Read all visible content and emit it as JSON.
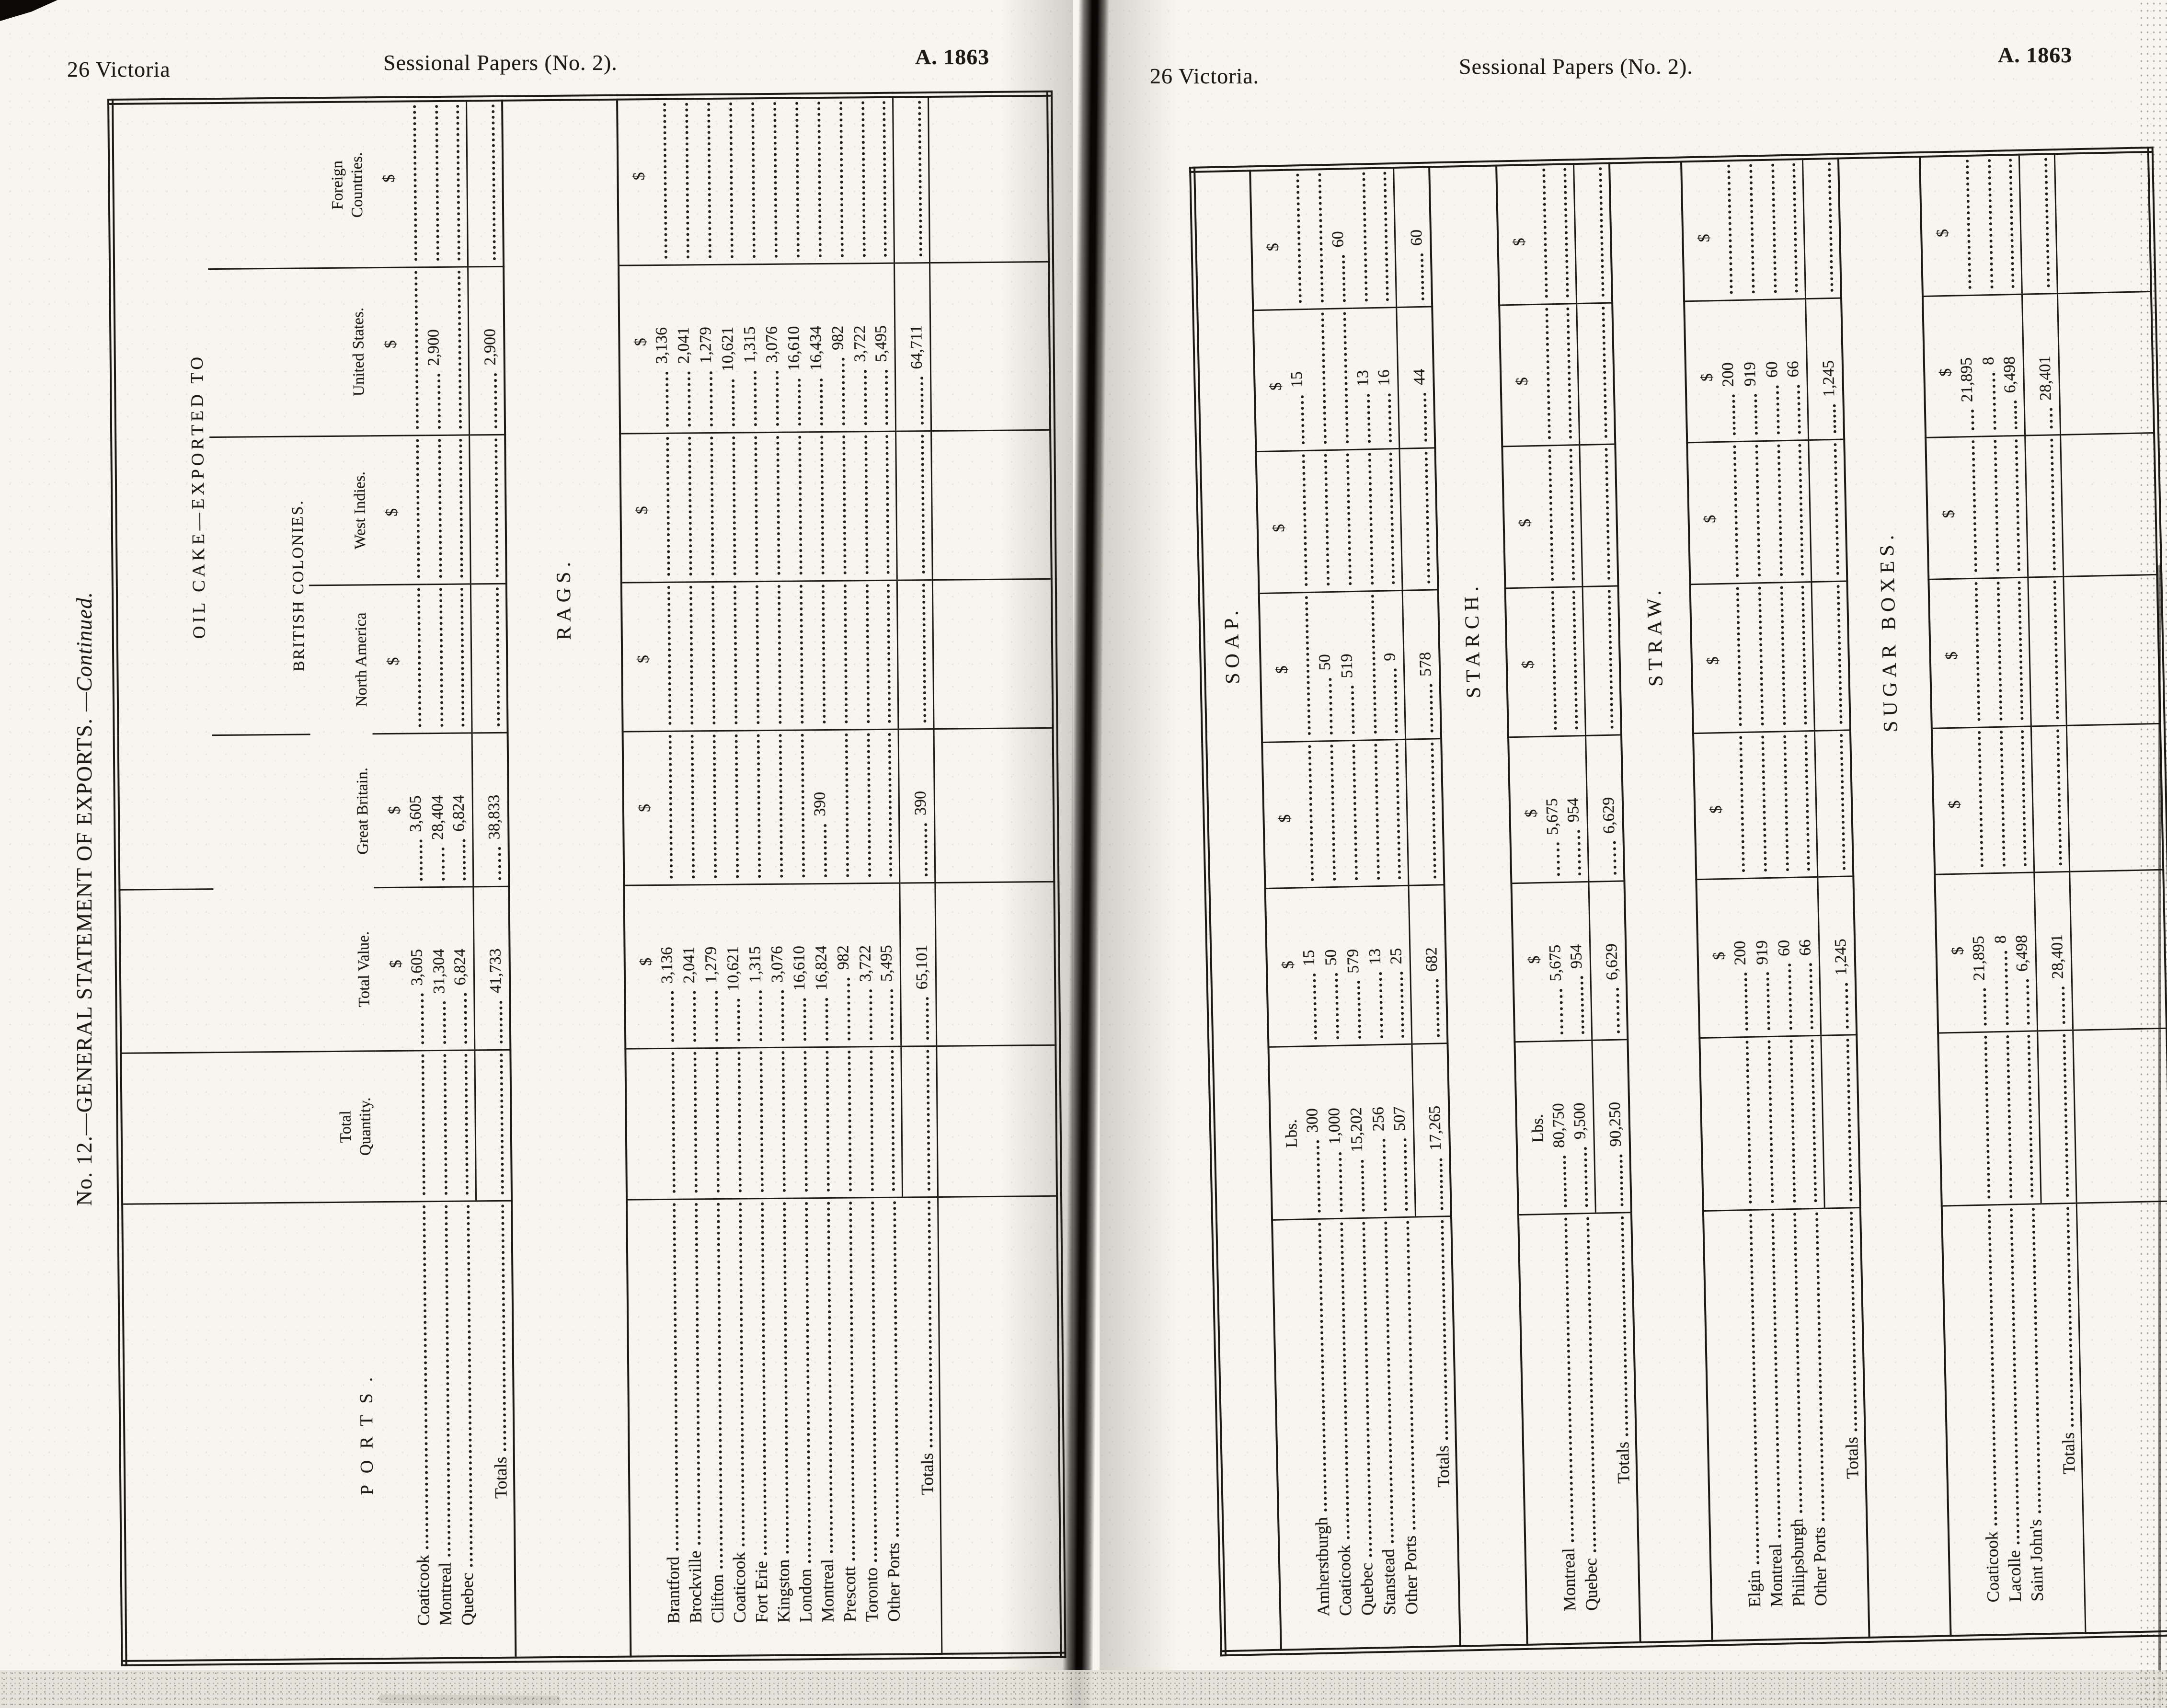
{
  "pages": {
    "left": {
      "header": {
        "left": "26 Victoria",
        "center": "Sessional Papers (No. 2).",
        "right": "A. 1863"
      },
      "side_title": {
        "main": "No. 12.—GENERAL STATEMENT OF EXPORTS.",
        "suffix": "—Continued."
      },
      "table": {
        "columns": [
          "port",
          "tq",
          "tv",
          "gb",
          "na",
          "wi",
          "us",
          "fc"
        ],
        "headers": {
          "ports": "PORTS.",
          "total_quantity": "Total Quantity.",
          "total_value": "Total Value.",
          "exported_to": "OIL CAKE—EXPORTED TO",
          "great_britain": "Great Britain.",
          "british_colonies": "BRITISH COLONIES.",
          "north_america": "North America",
          "west_indies": "West Indies.",
          "united_states": "United States.",
          "foreign_countries": "Foreign Countries."
        },
        "sections": [
          {
            "label": null,
            "units": {
              "tv": "$",
              "gb": "$",
              "na": "$",
              "wi": "$",
              "us": "$",
              "fc": "$"
            },
            "rows": [
              {
                "port": "Coaticook",
                "cells": {
                  "tv": "3,605",
                  "gb": "3,605"
                }
              },
              {
                "port": "Montreal",
                "cells": {
                  "tv": "31,304",
                  "gb": "28,404",
                  "us": "2,900"
                }
              },
              {
                "port": "Quebec",
                "cells": {
                  "tv": "6,824",
                  "gb": "6,824"
                }
              }
            ],
            "totals": {
              "port": "Totals",
              "cells": {
                "tv": "41,733",
                "gb": "38,833",
                "us": "2,900"
              }
            }
          },
          {
            "label": "RAGS.",
            "units": {
              "tv": "$",
              "gb": "$",
              "na": "$",
              "wi": "$",
              "us": "$",
              "fc": "$"
            },
            "rows": [
              {
                "port": "Brantford",
                "cells": {
                  "tv": "3,136",
                  "us": "3,136"
                }
              },
              {
                "port": "Brockville",
                "cells": {
                  "tv": "2,041",
                  "us": "2,041"
                }
              },
              {
                "port": "Clifton",
                "cells": {
                  "tv": "1,279",
                  "us": "1,279"
                }
              },
              {
                "port": "Coaticook",
                "cells": {
                  "tv": "10,621",
                  "us": "10,621"
                }
              },
              {
                "port": "Fort Erie",
                "cells": {
                  "tv": "1,315",
                  "us": "1,315"
                }
              },
              {
                "port": "Kingston",
                "cells": {
                  "tv": "3,076",
                  "us": "3,076"
                }
              },
              {
                "port": "London",
                "cells": {
                  "tv": "16,610",
                  "us": "16,610"
                }
              },
              {
                "port": "Montreal",
                "cells": {
                  "tv": "16,824",
                  "gb": "390",
                  "us": "16,434"
                }
              },
              {
                "port": "Prescott",
                "cells": {
                  "tv": "982",
                  "us": "982"
                }
              },
              {
                "port": "Toronto",
                "cells": {
                  "tv": "3,722",
                  "us": "3,722"
                }
              },
              {
                "port": "Other Ports",
                "cells": {
                  "tv": "5,495",
                  "us": "5,495"
                }
              }
            ],
            "totals": {
              "port": "Totals",
              "cells": {
                "tv": "65,101",
                "gb": "390",
                "us": "64,711"
              }
            }
          }
        ]
      }
    },
    "right": {
      "header": {
        "left": "26 Victoria.",
        "center": "Sessional Papers (No. 2).",
        "right": "A. 1863"
      },
      "table": {
        "columns": [
          "port",
          "tq",
          "tv",
          "gb",
          "na",
          "wi",
          "us",
          "fc"
        ],
        "sections": [
          {
            "label": "SOAP.",
            "units": {
              "tq": "Lbs.",
              "tv": "$",
              "gb": "$",
              "na": "$",
              "wi": "$",
              "us": "$",
              "fc": "$"
            },
            "rows": [
              {
                "port": "Amherstburgh",
                "cells": {
                  "tq": "300",
                  "tv": "15",
                  "us": "15"
                }
              },
              {
                "port": "Coaticook",
                "cells": {
                  "tq": "1,000",
                  "tv": "50",
                  "na": "50"
                }
              },
              {
                "port": "Quebec",
                "cells": {
                  "tq": "15,202",
                  "tv": "579",
                  "na": "519",
                  "fc": "60"
                }
              },
              {
                "port": "Stanstead",
                "cells": {
                  "tq": "256",
                  "tv": "13",
                  "us": "13"
                }
              },
              {
                "port": "Other Ports",
                "cells": {
                  "tq": "507",
                  "tv": "25",
                  "na": "9",
                  "us": "16"
                }
              }
            ],
            "totals": {
              "port": "Totals",
              "cells": {
                "tq": "17,265",
                "tv": "682",
                "na": "578",
                "us": "44",
                "fc": "60"
              }
            }
          },
          {
            "label": "STARCH.",
            "units": {
              "tq": "Lbs.",
              "tv": "$",
              "gb": "$",
              "na": "$",
              "wi": "$",
              "us": "$",
              "fc": "$"
            },
            "rows": [
              {
                "port": "Montreal",
                "cells": {
                  "tq": "80,750",
                  "tv": "5,675",
                  "gb": "5,675"
                }
              },
              {
                "port": "Quebec",
                "cells": {
                  "tq": "9,500",
                  "tv": "954",
                  "gb": "954"
                }
              }
            ],
            "totals": {
              "port": "Totals",
              "cells": {
                "tq": "90,250",
                "tv": "6,629",
                "gb": "6,629"
              }
            }
          },
          {
            "label": "STRAW.",
            "units": {
              "tv": "$",
              "gb": "$",
              "na": "$",
              "wi": "$",
              "us": "$",
              "fc": "$"
            },
            "rows": [
              {
                "port": "Elgin",
                "cells": {
                  "tv": "200",
                  "us": "200"
                }
              },
              {
                "port": "Montreal",
                "cells": {
                  "tv": "919",
                  "us": "919"
                }
              },
              {
                "port": "Philipsburgh",
                "cells": {
                  "tv": "60",
                  "us": "60"
                }
              },
              {
                "port": "Other Ports",
                "cells": {
                  "tv": "66",
                  "us": "66"
                }
              }
            ],
            "totals": {
              "port": "Totals",
              "cells": {
                "tv": "1,245",
                "us": "1,245"
              }
            }
          },
          {
            "label": "SUGAR BOXES.",
            "units": {
              "tv": "$",
              "gb": "$",
              "na": "$",
              "wi": "$",
              "us": "$",
              "fc": "$"
            },
            "rows": [
              {
                "port": "Coaticook",
                "cells": {
                  "tv": "21,895",
                  "us": "21,895"
                }
              },
              {
                "port": "Lacolle",
                "cells": {
                  "tv": "8",
                  "us": "8"
                }
              },
              {
                "port": "Saint John's",
                "cells": {
                  "tv": "6,498",
                  "us": "6,498"
                }
              }
            ],
            "totals": {
              "port": "Totals",
              "cells": {
                "tv": "28,401",
                "us": "28,401"
              }
            }
          }
        ]
      }
    }
  }
}
